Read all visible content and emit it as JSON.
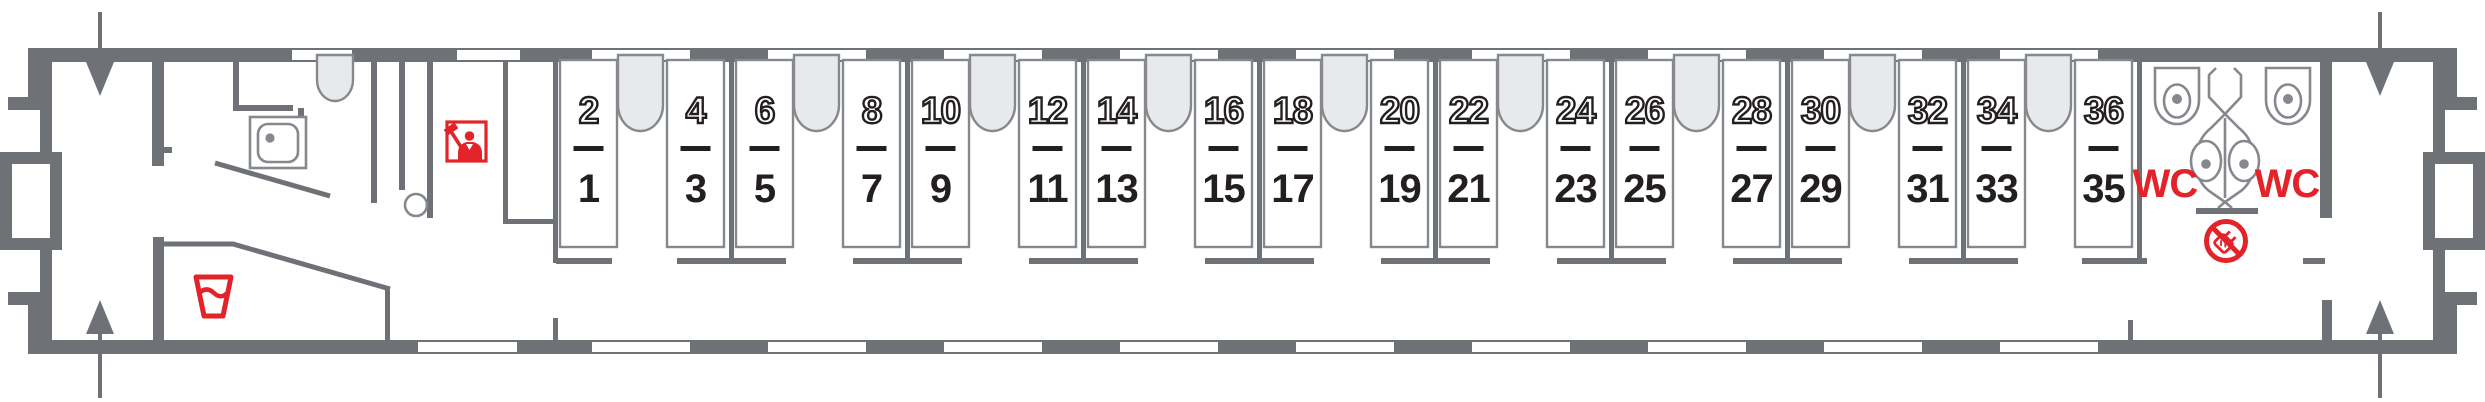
{
  "car": {
    "kind": "railway-sleeping-car-floorplan",
    "berth_count": 36,
    "colors": {
      "wall": "#6e7276",
      "outline": "#85898d",
      "light_fill": "#e8e9ea",
      "ink": "#231f20",
      "red": "#e2242a",
      "white": "#ffffff"
    },
    "wc": {
      "left_label": "WC",
      "right_label": "WC"
    },
    "compartments": [
      {
        "columns": [
          {
            "upper": "2",
            "lower": "1"
          },
          {
            "upper": "4",
            "lower": "3"
          }
        ]
      },
      {
        "columns": [
          {
            "upper": "6",
            "lower": "5"
          },
          {
            "upper": "8",
            "lower": "7"
          }
        ]
      },
      {
        "columns": [
          {
            "upper": "10",
            "lower": "9"
          },
          {
            "upper": "12",
            "lower": "11"
          }
        ]
      },
      {
        "columns": [
          {
            "upper": "14",
            "lower": "13"
          },
          {
            "upper": "16",
            "lower": "15"
          }
        ]
      },
      {
        "columns": [
          {
            "upper": "18",
            "lower": "17"
          },
          {
            "upper": "20",
            "lower": "19"
          }
        ]
      },
      {
        "columns": [
          {
            "upper": "22",
            "lower": "21"
          },
          {
            "upper": "24",
            "lower": "23"
          }
        ]
      },
      {
        "columns": [
          {
            "upper": "26",
            "lower": "25"
          },
          {
            "upper": "28",
            "lower": "27"
          }
        ]
      },
      {
        "columns": [
          {
            "upper": "30",
            "lower": "29"
          },
          {
            "upper": "32",
            "lower": "31"
          }
        ]
      },
      {
        "columns": [
          {
            "upper": "34",
            "lower": "33"
          },
          {
            "upper": "36",
            "lower": "35"
          }
        ]
      }
    ],
    "icons": {
      "drinking_water": "drinking-water-cup-icon",
      "conductor": "conductor-icon",
      "service_washbasin": "washbasin-icon",
      "toilet_left": "toilet-icon",
      "toilet_right": "toilet-icon",
      "wc_washstand": "double-washbasin-icon",
      "no_socket": "crossed-plug-icon",
      "entry_doors": "entry-arrow-icon"
    }
  }
}
